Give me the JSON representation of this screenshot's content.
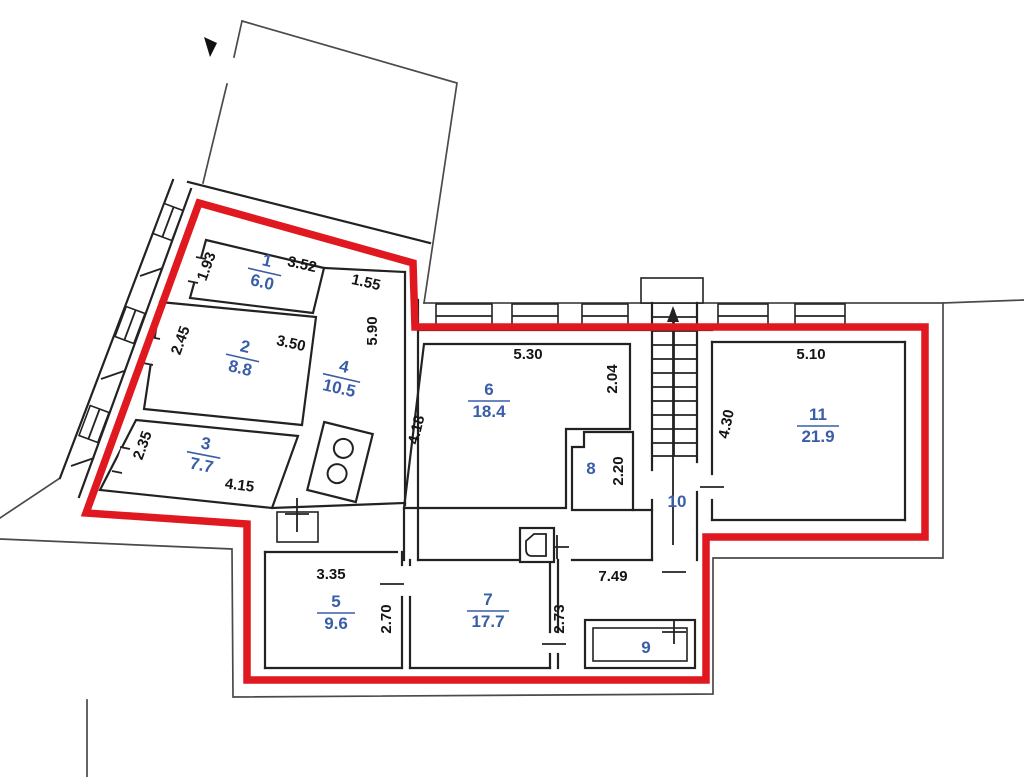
{
  "plan": {
    "name": "Apartment floor plan with red boundary outline",
    "boundary_color": "#e0181f",
    "room_label_color": "#3a5da8",
    "dimension_color": "#141414",
    "rooms": {
      "r1": {
        "number": "1",
        "area": "6.0"
      },
      "r2": {
        "number": "2",
        "area": "8.8"
      },
      "r3": {
        "number": "3",
        "area": "7.7"
      },
      "r4": {
        "number": "4",
        "area": "10.5"
      },
      "r5": {
        "number": "5",
        "area": "9.6"
      },
      "r6": {
        "number": "6",
        "area": "18.4"
      },
      "r7": {
        "number": "7",
        "area": "17.7"
      },
      "r8": {
        "number": "8",
        "area": ""
      },
      "r9": {
        "number": "9",
        "area": ""
      },
      "r10": {
        "number": "10",
        "area": ""
      },
      "r11": {
        "number": "11",
        "area": "21.9"
      }
    },
    "dims": {
      "d1": "1.93",
      "d2": "3.52",
      "d3": "1.55",
      "d4": "2.45",
      "d5": "3.50",
      "d6": "5.90",
      "d7": "2.35",
      "d8": "4.15",
      "d9": "5.30",
      "d10": "4.18",
      "d11": "2.04",
      "d12": "2.20",
      "d13": "5.10",
      "d14": "4.30",
      "d15": "3.35",
      "d16": "2.70",
      "d17": "7.49",
      "d18": "2.73"
    }
  }
}
